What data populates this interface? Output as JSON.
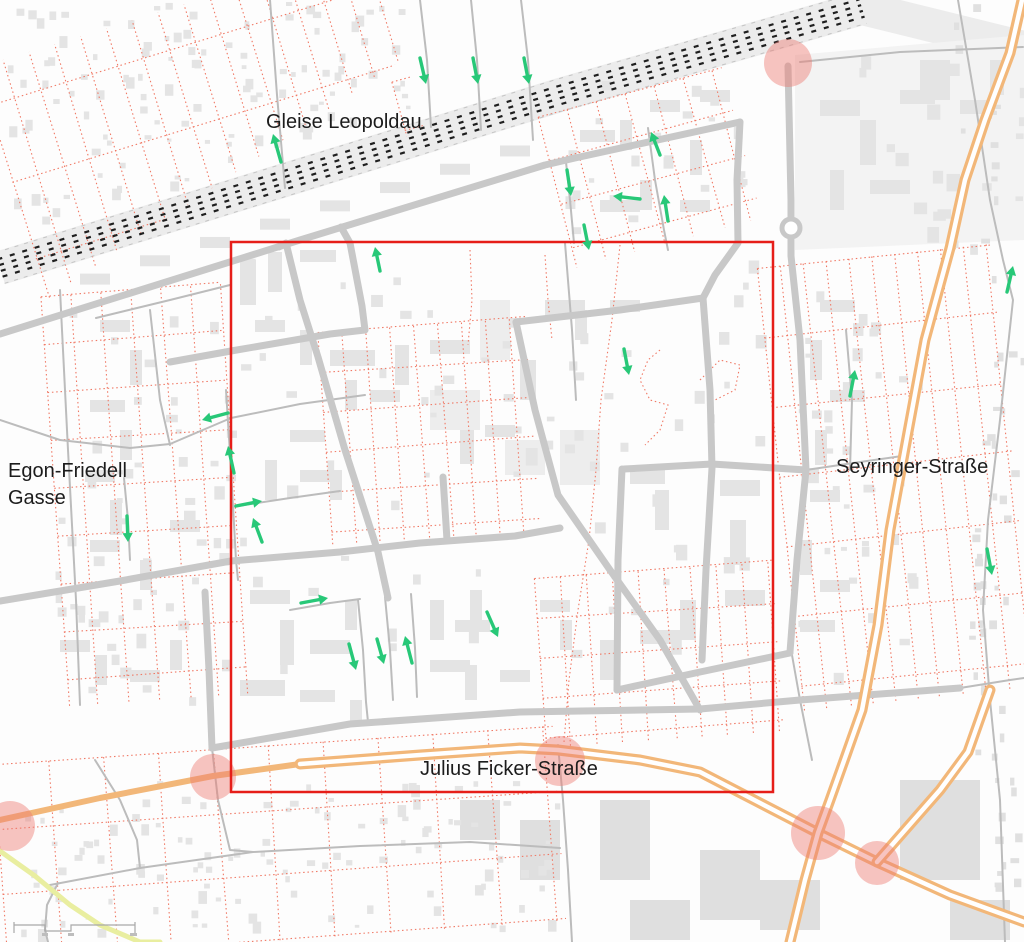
{
  "map": {
    "labels": [
      {
        "id": "gleise-leopoldau",
        "text": "Gleise Leopoldau",
        "x": 266,
        "y": 112,
        "size": 20
      },
      {
        "id": "egon-friedell",
        "text": "Egon-Friedell",
        "x": 8,
        "y": 461,
        "size": 20
      },
      {
        "id": "egon-friedell-2",
        "text": "Gasse",
        "x": 8,
        "y": 488,
        "size": 20
      },
      {
        "id": "seyringer-strasse",
        "text": "Seyringer-Straße",
        "x": 836,
        "y": 457,
        "size": 20
      },
      {
        "id": "julius-ficker-strasse",
        "text": "Julius Ficker-Straße",
        "x": 420,
        "y": 759,
        "size": 20
      }
    ],
    "colors": {
      "background": "#fdfdfd",
      "building": "#e4e4e4",
      "building_big": "#ededed",
      "industrial": "#dfdfdf",
      "road_major": "#c8c8c8",
      "road_minor": "#bcbcbc",
      "rail_band": "#ececec",
      "rail_dash": "#1f1f1f",
      "parcel_red": "#f07864",
      "study_rect": "#e61e19",
      "arrow_green": "#28c878",
      "orange_road": "#f2b779",
      "impact_pink": "#ee7d73",
      "yellow_path": "#e9eea0",
      "scalebar": "#a9a9a9"
    },
    "study_rect": {
      "x": 231,
      "y": 242,
      "w": 542,
      "h": 550
    },
    "arrows": [
      {
        "x1": 420,
        "y1": 58,
        "x2": 426,
        "y2": 84
      },
      {
        "x1": 473,
        "y1": 58,
        "x2": 478,
        "y2": 84
      },
      {
        "x1": 524,
        "y1": 58,
        "x2": 529,
        "y2": 84
      },
      {
        "x1": 281,
        "y1": 162,
        "x2": 273,
        "y2": 134
      },
      {
        "x1": 567,
        "y1": 170,
        "x2": 571,
        "y2": 196
      },
      {
        "x1": 660,
        "y1": 155,
        "x2": 651,
        "y2": 132
      },
      {
        "x1": 640,
        "y1": 199,
        "x2": 613,
        "y2": 196
      },
      {
        "x1": 668,
        "y1": 221,
        "x2": 664,
        "y2": 195
      },
      {
        "x1": 584,
        "y1": 225,
        "x2": 589,
        "y2": 250
      },
      {
        "x1": 380,
        "y1": 271,
        "x2": 375,
        "y2": 247
      },
      {
        "x1": 624,
        "y1": 349,
        "x2": 629,
        "y2": 375
      },
      {
        "x1": 850,
        "y1": 396,
        "x2": 855,
        "y2": 370
      },
      {
        "x1": 1007,
        "y1": 292,
        "x2": 1013,
        "y2": 266
      },
      {
        "x1": 987,
        "y1": 549,
        "x2": 992,
        "y2": 575
      },
      {
        "x1": 228,
        "y1": 413,
        "x2": 202,
        "y2": 420
      },
      {
        "x1": 234,
        "y1": 473,
        "x2": 228,
        "y2": 446
      },
      {
        "x1": 236,
        "y1": 506,
        "x2": 262,
        "y2": 501
      },
      {
        "x1": 262,
        "y1": 542,
        "x2": 253,
        "y2": 518
      },
      {
        "x1": 127,
        "y1": 516,
        "x2": 128,
        "y2": 542
      },
      {
        "x1": 301,
        "y1": 603,
        "x2": 328,
        "y2": 598
      },
      {
        "x1": 349,
        "y1": 644,
        "x2": 356,
        "y2": 670
      },
      {
        "x1": 377,
        "y1": 639,
        "x2": 384,
        "y2": 664
      },
      {
        "x1": 412,
        "y1": 663,
        "x2": 405,
        "y2": 636
      },
      {
        "x1": 487,
        "y1": 612,
        "x2": 498,
        "y2": 637
      }
    ],
    "impact_circles": [
      {
        "cx": 788,
        "cy": 63,
        "r": 24
      },
      {
        "cx": 213,
        "cy": 777,
        "r": 23
      },
      {
        "cx": 10,
        "cy": 826,
        "r": 25
      },
      {
        "cx": 560,
        "cy": 761,
        "r": 25
      },
      {
        "cx": 818,
        "cy": 833,
        "r": 27
      },
      {
        "cx": 877,
        "cy": 863,
        "r": 22
      }
    ],
    "railway": {
      "line": [
        [
          0,
          268
        ],
        [
          560,
          95
        ],
        [
          862,
          8
        ],
        [
          1024,
          48
        ]
      ],
      "band_width": 34
    },
    "roads_major": [
      [
        [
          0,
          334
        ],
        [
          300,
          240
        ],
        [
          545,
          165
        ],
        [
          575,
          158
        ],
        [
          740,
          122
        ]
      ],
      [
        [
          740,
          122
        ],
        [
          737,
          180
        ],
        [
          738,
          243
        ],
        [
          715,
          275
        ],
        [
          703,
          298
        ]
      ],
      [
        [
          788,
          66
        ],
        [
          791,
          200
        ],
        [
          791,
          256
        ],
        [
          800,
          340
        ],
        [
          806,
          470
        ],
        [
          797,
          560
        ],
        [
          790,
          652
        ]
      ],
      [
        [
          279,
          247
        ],
        [
          286,
          243
        ],
        [
          300,
          300
        ],
        [
          318,
          357
        ],
        [
          345,
          450
        ],
        [
          378,
          552
        ],
        [
          388,
          598
        ]
      ],
      [
        [
          170,
          362
        ],
        [
          231,
          351
        ],
        [
          330,
          334
        ],
        [
          365,
          330
        ]
      ],
      [
        [
          341,
          227
        ],
        [
          350,
          243
        ],
        [
          362,
          306
        ],
        [
          365,
          330
        ]
      ],
      [
        [
          0,
          601
        ],
        [
          120,
          581
        ],
        [
          231,
          561
        ],
        [
          340,
          552
        ],
        [
          420,
          543
        ],
        [
          515,
          536
        ],
        [
          560,
          528
        ]
      ],
      [
        [
          516,
          322
        ],
        [
          535,
          410
        ],
        [
          558,
          495
        ],
        [
          610,
          570
        ],
        [
          660,
          640
        ],
        [
          700,
          710
        ]
      ],
      [
        [
          516,
          322
        ],
        [
          620,
          310
        ],
        [
          703,
          298
        ]
      ],
      [
        [
          212,
          748
        ],
        [
          350,
          724
        ],
        [
          520,
          712
        ],
        [
          700,
          709
        ],
        [
          800,
          700
        ],
        [
          960,
          688
        ]
      ],
      [
        [
          205,
          592
        ],
        [
          209,
          670
        ],
        [
          212,
          748
        ]
      ],
      [
        [
          703,
          298
        ],
        [
          710,
          390
        ],
        [
          712,
          468
        ],
        [
          706,
          570
        ],
        [
          702,
          660
        ]
      ],
      [
        [
          624,
          469
        ],
        [
          712,
          464
        ],
        [
          806,
          470
        ]
      ],
      [
        [
          622,
          469
        ],
        [
          618,
          560
        ],
        [
          617,
          690
        ]
      ],
      [
        [
          617,
          690
        ],
        [
          700,
          672
        ],
        [
          790,
          653
        ]
      ],
      [
        [
          443,
          477
        ],
        [
          447,
          540
        ]
      ]
    ],
    "roads_minor": [
      [
        [
          420,
          0
        ],
        [
          427,
          60
        ],
        [
          431,
          127
        ]
      ],
      [
        [
          471,
          0
        ],
        [
          477,
          60
        ],
        [
          481,
          130
        ]
      ],
      [
        [
          521,
          0
        ],
        [
          528,
          60
        ],
        [
          533,
          140
        ]
      ],
      [
        [
          270,
          0
        ],
        [
          277,
          95
        ],
        [
          285,
          188
        ]
      ],
      [
        [
          60,
          290
        ],
        [
          68,
          450
        ],
        [
          76,
          600
        ],
        [
          80,
          705
        ]
      ],
      [
        [
          0,
          420
        ],
        [
          60,
          440
        ],
        [
          130,
          448
        ],
        [
          170,
          444
        ],
        [
          231,
          418
        ],
        [
          300,
          404
        ],
        [
          365,
          395
        ]
      ],
      [
        [
          226,
          390
        ],
        [
          231,
          470
        ],
        [
          236,
          560
        ],
        [
          238,
          580
        ]
      ],
      [
        [
          231,
          507
        ],
        [
          290,
          498
        ],
        [
          340,
          491
        ]
      ],
      [
        [
          124,
          478
        ],
        [
          128,
          520
        ],
        [
          130,
          560
        ]
      ],
      [
        [
          290,
          610
        ],
        [
          330,
          603
        ],
        [
          360,
          599
        ]
      ],
      [
        [
          358,
          600
        ],
        [
          363,
          650
        ],
        [
          366,
          702
        ],
        [
          368,
          722
        ]
      ],
      [
        [
          385,
          597
        ],
        [
          390,
          650
        ],
        [
          393,
          700
        ]
      ],
      [
        [
          411,
          594
        ],
        [
          415,
          648
        ],
        [
          417,
          697
        ]
      ],
      [
        [
          566,
          162
        ],
        [
          570,
          200
        ],
        [
          574,
          243
        ]
      ],
      [
        [
          648,
          128
        ],
        [
          655,
          180
        ],
        [
          664,
          230
        ],
        [
          668,
          250
        ]
      ],
      [
        [
          565,
          243
        ],
        [
          572,
          330
        ],
        [
          576,
          400
        ]
      ],
      [
        [
          958,
          0
        ],
        [
          975,
          100
        ],
        [
          990,
          200
        ],
        [
          1003,
          260
        ],
        [
          1013,
          300
        ],
        [
          1000,
          420
        ],
        [
          988,
          520
        ],
        [
          983,
          610
        ],
        [
          990,
          700
        ],
        [
          1000,
          800
        ],
        [
          1005,
          942
        ]
      ],
      [
        [
          212,
          748
        ],
        [
          218,
          800
        ],
        [
          230,
          850
        ],
        [
          253,
          852
        ]
      ],
      [
        [
          50,
          885
        ],
        [
          140,
          868
        ],
        [
          253,
          852
        ],
        [
          360,
          846
        ],
        [
          470,
          842
        ],
        [
          560,
          848
        ]
      ],
      [
        [
          58,
          883
        ],
        [
          47,
          905
        ],
        [
          45,
          930
        ],
        [
          48,
          942
        ]
      ],
      [
        [
          558,
          745
        ],
        [
          563,
          800
        ],
        [
          568,
          870
        ],
        [
          572,
          942
        ]
      ],
      [
        [
          792,
          655
        ],
        [
          800,
          700
        ],
        [
          812,
          760
        ]
      ],
      [
        [
          800,
          62
        ],
        [
          900,
          52
        ],
        [
          1023,
          47
        ]
      ],
      [
        [
          806,
          470
        ],
        [
          860,
          462
        ],
        [
          902,
          456
        ]
      ],
      [
        [
          846,
          330
        ],
        [
          852,
          400
        ],
        [
          850,
          470
        ]
      ],
      [
        [
          96,
          318
        ],
        [
          170,
          300
        ],
        [
          230,
          285
        ]
      ],
      [
        [
          150,
          310
        ],
        [
          160,
          400
        ],
        [
          170,
          445
        ]
      ],
      [
        [
          95,
          760
        ],
        [
          120,
          800
        ],
        [
          137,
          840
        ],
        [
          140,
          868
        ]
      ],
      [
        [
          960,
          688
        ],
        [
          1010,
          680
        ],
        [
          1024,
          678
        ]
      ]
    ],
    "roundabout": {
      "cx": 791,
      "cy": 228,
      "r": 9
    },
    "orange_single": [
      [
        [
          0,
          820
        ],
        [
          100,
          798
        ],
        [
          213,
          776
        ],
        [
          300,
          764
        ]
      ]
    ],
    "orange_dual": [
      [
        [
          300,
          764
        ],
        [
          420,
          755
        ],
        [
          520,
          748
        ],
        [
          558,
          750
        ],
        [
          640,
          760
        ],
        [
          700,
          772
        ],
        [
          760,
          803
        ],
        [
          818,
          833
        ],
        [
          877,
          862
        ],
        [
          950,
          895
        ],
        [
          1024,
          922
        ]
      ],
      [
        [
          1022,
          0
        ],
        [
          1010,
          53
        ],
        [
          985,
          120
        ],
        [
          965,
          180
        ],
        [
          950,
          248
        ],
        [
          925,
          340
        ],
        [
          908,
          432
        ],
        [
          890,
          530
        ],
        [
          878,
          625
        ],
        [
          862,
          710
        ],
        [
          845,
          758
        ],
        [
          830,
          800
        ],
        [
          818,
          833
        ],
        [
          805,
          880
        ],
        [
          790,
          942
        ]
      ],
      [
        [
          990,
          690
        ],
        [
          968,
          752
        ],
        [
          940,
          790
        ],
        [
          905,
          830
        ],
        [
          877,
          862
        ]
      ]
    ],
    "yellow_path": [
      [
        0,
        851
      ],
      [
        35,
        876
      ],
      [
        70,
        905
      ],
      [
        100,
        925
      ],
      [
        140,
        942
      ],
      [
        160,
        942
      ]
    ],
    "scale_bar": {
      "x": 14,
      "y": 925,
      "width": 121
    }
  }
}
